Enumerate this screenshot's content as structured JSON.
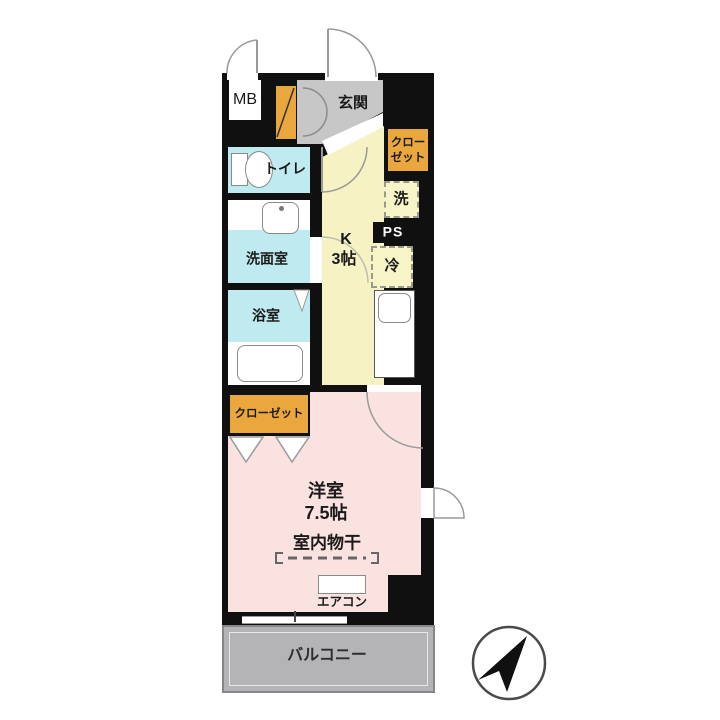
{
  "plan": {
    "rooms": {
      "mb": "MB",
      "entrance": "玄関",
      "closet_upper_line1": "クロー",
      "closet_upper_line2": "ゼット",
      "washer": "洗",
      "ps": "PS",
      "fridge": "冷",
      "kitchen_label": "K",
      "kitchen_size": "3帖",
      "toilet": "トイレ",
      "washroom": "洗面室",
      "bathroom": "浴室",
      "closet_lower": "クローゼット",
      "western_room_label": "洋室",
      "western_room_size": "7.5帖",
      "indoor_drying": "室内物干",
      "aircon": "エアコン",
      "balcony": "バルコニー"
    },
    "colors": {
      "wall": "#101010",
      "closet_orange": "#e9a73e",
      "kitchen_yellow": "#f6f2c3",
      "wet_area_cyan": "#bfeaef",
      "room_pink": "#fae2e1",
      "entrance_gray": "#c7c7c7",
      "balcony_gray": "#b4b4b7"
    },
    "icons": [
      "north-arrow",
      "toilet-bowl",
      "sink",
      "bathtub",
      "door-swing"
    ]
  }
}
